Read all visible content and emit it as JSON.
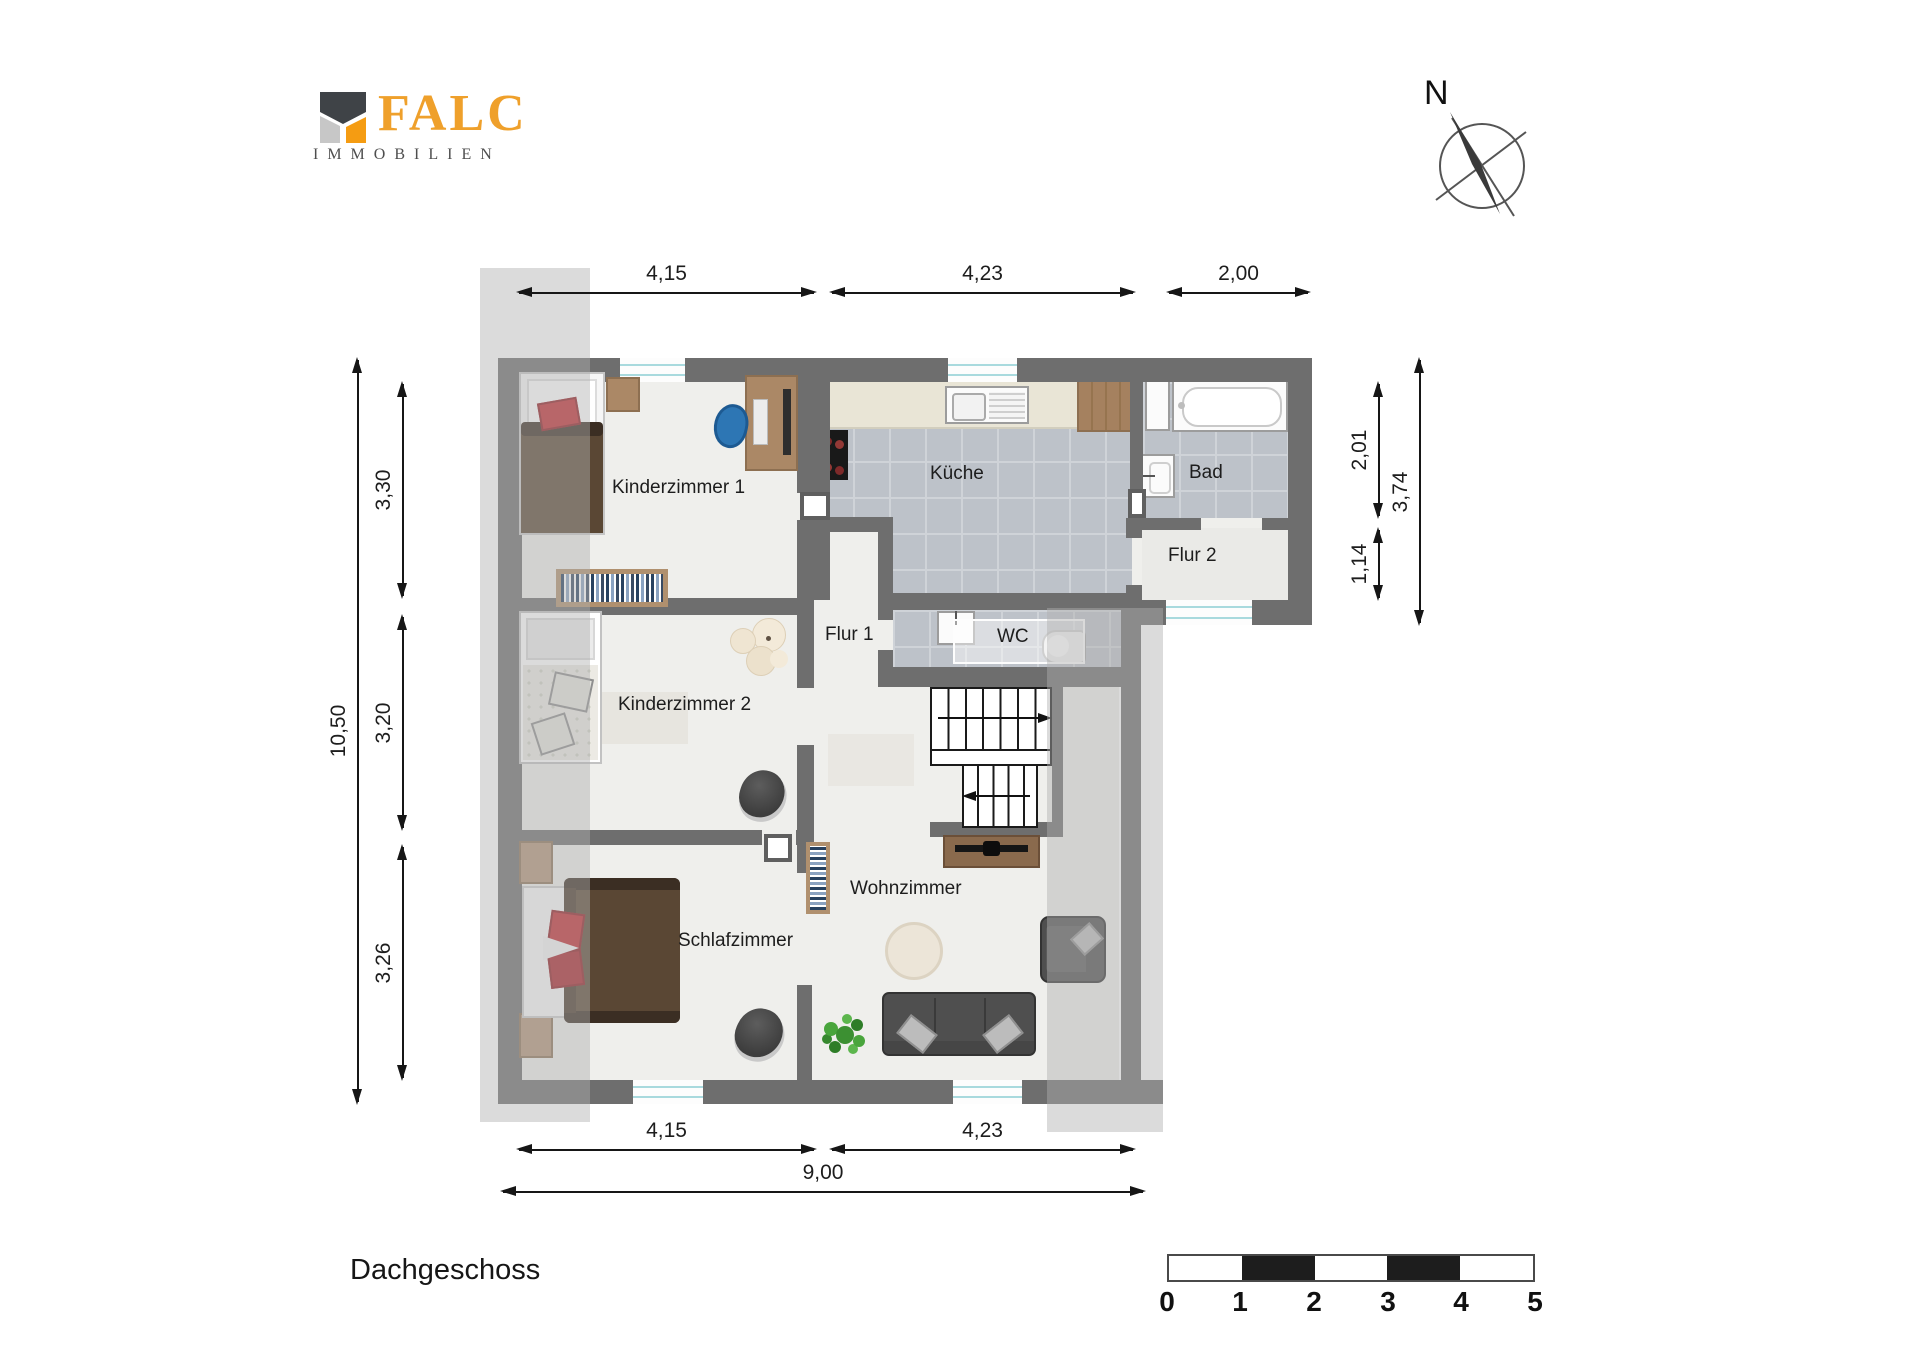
{
  "logo": {
    "brand": "FALC",
    "subtitle": "IMMOBILIEN"
  },
  "compass": {
    "label": "N"
  },
  "floor_title": "Dachgeschoss",
  "rooms": {
    "kinderzimmer1": {
      "label": "Kinderzimmer 1"
    },
    "kinderzimmer2": {
      "label": "Kinderzimmer 2"
    },
    "schlafzimmer": {
      "label": "Schlafzimmer"
    },
    "flur1": {
      "label": "Flur 1"
    },
    "flur2": {
      "label": "Flur 2"
    },
    "kueche": {
      "label": "Küche"
    },
    "bad": {
      "label": "Bad"
    },
    "wc": {
      "label": "WC"
    },
    "wohnzimmer": {
      "label": "Wohnzimmer"
    }
  },
  "dimensions": {
    "top": {
      "d1": "4,15",
      "d2": "4,23",
      "d3": "2,00"
    },
    "bottom": {
      "d1": "4,15",
      "d2": "4,23",
      "total": "9,00"
    },
    "left": {
      "d1": "3,30",
      "d2": "3,20",
      "d3": "3,26",
      "total": "10,50"
    },
    "right": {
      "d1": "2,01",
      "d2": "1,14",
      "total": "3,74"
    }
  },
  "scale_bar": {
    "t0": "0",
    "t1": "1",
    "t2": "2",
    "t3": "3",
    "t4": "4",
    "t5": "5"
  },
  "icons": {
    "logo_mark": "falc-house-icon",
    "compass": "compass-north-icon"
  },
  "colors": {
    "wall": "#6e6e6e",
    "floor": "#efefec",
    "tile": "#bdc2c9",
    "accent_orange": "#efa02b",
    "wood": "#ab8866",
    "sofa": "#4f4f4f",
    "red_pillow": "#bf2a30",
    "plant": "#3c9032",
    "overlay": "rgba(176,176,176,0.45)",
    "window_glass": "#a9dade"
  }
}
